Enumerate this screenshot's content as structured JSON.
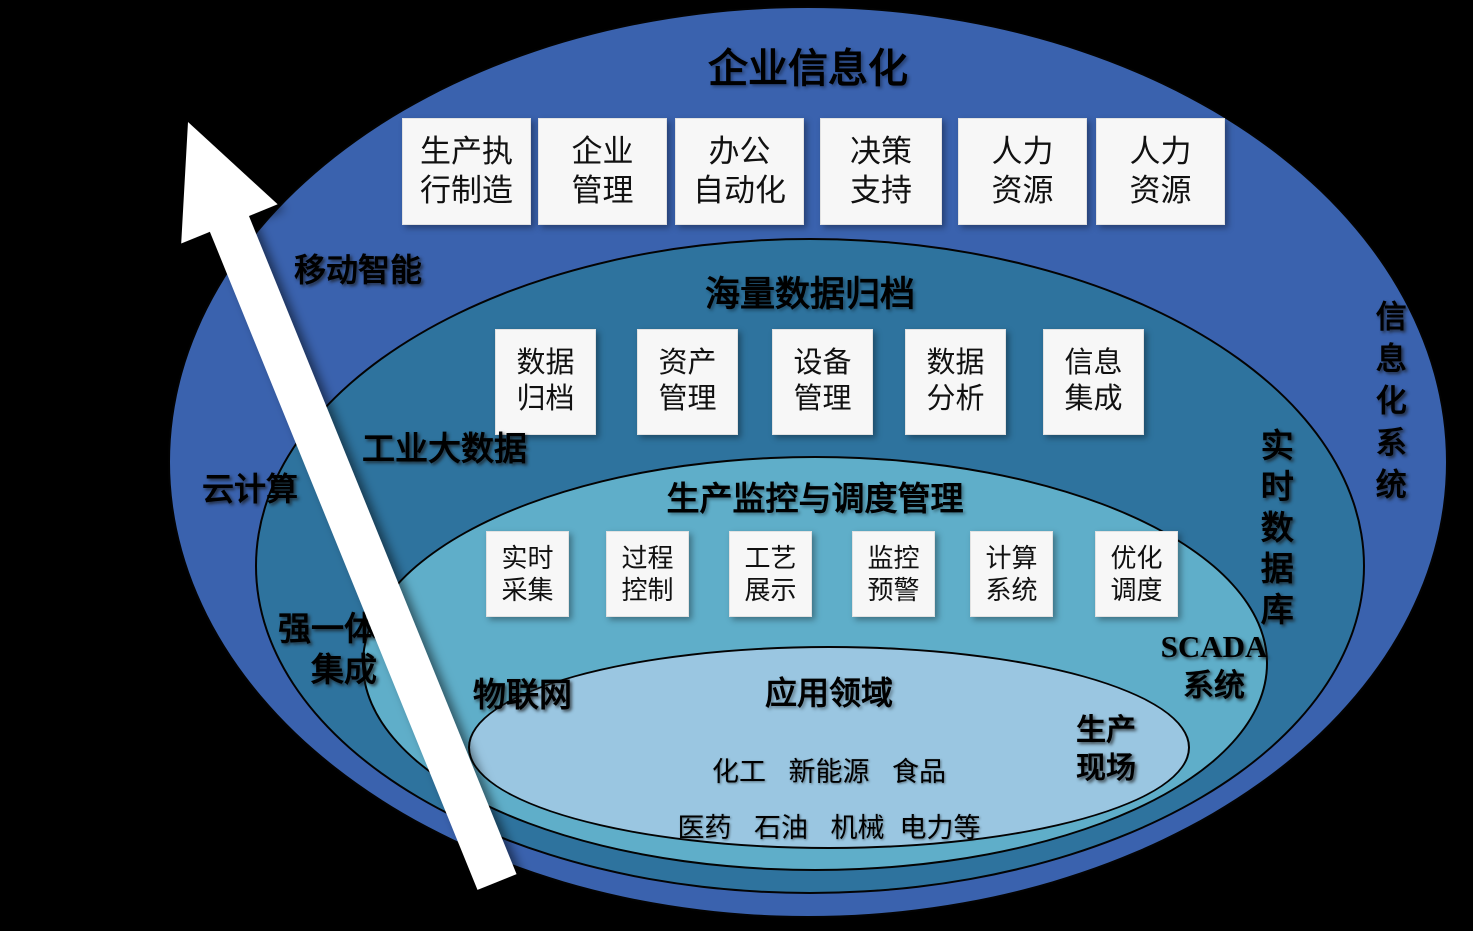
{
  "colors": {
    "background": "#000000",
    "ring_enterprise": "#3A62AE",
    "ring_data_archive": "#2E739E",
    "ring_production_monitoring": "#5FAEC9",
    "ring_application": "#9AC6E1",
    "box_fill": "#F7F7F7",
    "arrow": "#FFFFFF",
    "text": "#000000"
  },
  "layers": {
    "enterprise": {
      "title": "企业信息化",
      "boxes": [
        {
          "line1": "生产执",
          "line2": "行制造"
        },
        {
          "line1": "企业",
          "line2": "管理"
        },
        {
          "line1": "办公",
          "line2": "自动化"
        },
        {
          "line1": "决策",
          "line2": "支持"
        },
        {
          "line1": "人力",
          "line2": "资源"
        },
        {
          "line1": "人力",
          "line2": "资源"
        }
      ],
      "labels": {
        "mobile_intelligence": "移动智能",
        "cloud_computing": "云计算",
        "informatization_system": "信息化系统"
      }
    },
    "data_archive": {
      "title": "海量数据归档",
      "boxes": [
        {
          "line1": "数据",
          "line2": "归档"
        },
        {
          "line1": "资产",
          "line2": "管理"
        },
        {
          "line1": "设备",
          "line2": "管理"
        },
        {
          "line1": "数据",
          "line2": "分析"
        },
        {
          "line1": "信息",
          "line2": "集成"
        }
      ],
      "labels": {
        "industrial_big_data": "工业大数据",
        "integration_line1": "强一体化",
        "integration_line2": "集成",
        "realtime_database": "实时数据库"
      }
    },
    "production_monitoring": {
      "title": "生产监控与调度管理",
      "boxes": [
        {
          "line1": "实时",
          "line2": "采集"
        },
        {
          "line1": "过程",
          "line2": "控制"
        },
        {
          "line1": "工艺",
          "line2": "展示"
        },
        {
          "line1": "监控",
          "line2": "预警"
        },
        {
          "line1": "计算",
          "line2": "系统"
        },
        {
          "line1": "优化",
          "line2": "调度"
        }
      ],
      "labels": {
        "iot": "物联网",
        "scada_line1": "SCADA",
        "scada_line2": "系统"
      }
    },
    "application": {
      "title": "应用领域",
      "industries_line1": "化工   新能源   食品",
      "industries_line2": "医药   石油   机械  电力等",
      "labels": {
        "production_site_line1": "生产",
        "production_site_line2": "现场"
      }
    }
  }
}
